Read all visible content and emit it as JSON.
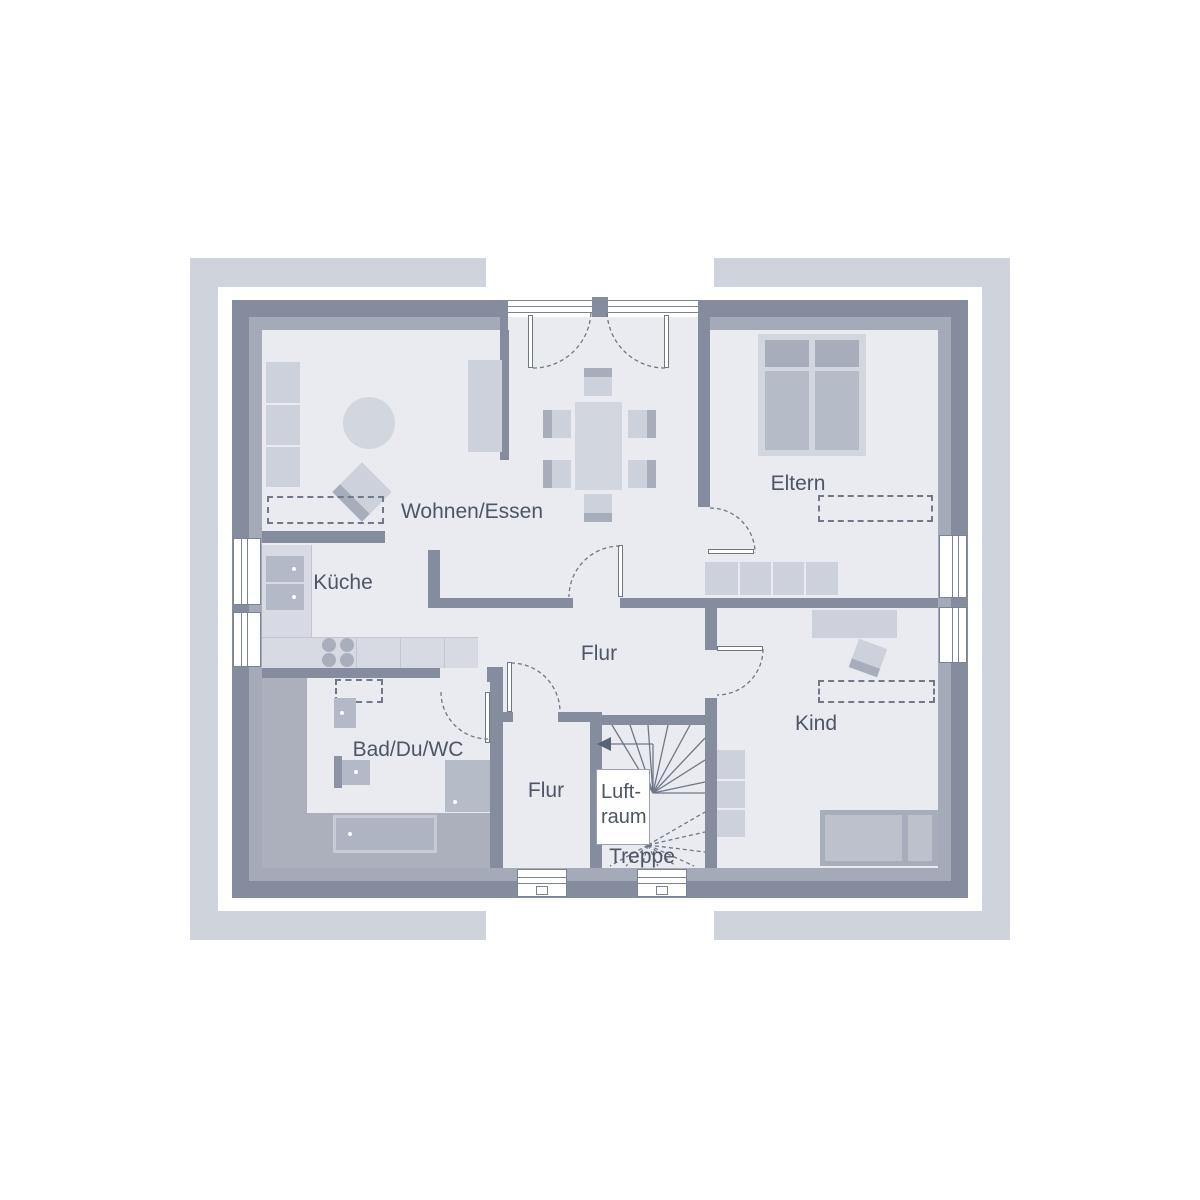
{
  "floorplan": {
    "rooms": [
      {
        "id": "wohnen-essen",
        "label": "Wohnen/Essen"
      },
      {
        "id": "kueche",
        "label": "Küche"
      },
      {
        "id": "eltern",
        "label": "Eltern"
      },
      {
        "id": "flur-mitte",
        "label": "Flur"
      },
      {
        "id": "bad-du-wc",
        "label": "Bad/Du/WC"
      },
      {
        "id": "flur-unten",
        "label": "Flur"
      },
      {
        "id": "treppe",
        "label": "Treppe"
      },
      {
        "id": "kind",
        "label": "Kind"
      }
    ],
    "luftraum": {
      "line1": "Luft-",
      "line2": "raum"
    },
    "colors": {
      "page_background": "#ffffff",
      "frame_marks": "#cfd3dc",
      "wall_dark": "#858c9e",
      "wall_inner_band": "#a4aab7",
      "floor": "#e9ebf0",
      "bath_zone": "#abb0bc",
      "furniture_light": "#cdd1db",
      "furniture_medium": "#b6bbc8",
      "furniture_dark": "#a7adbb",
      "dashed_outline": "#707889",
      "label_text": "#4d5566"
    }
  }
}
